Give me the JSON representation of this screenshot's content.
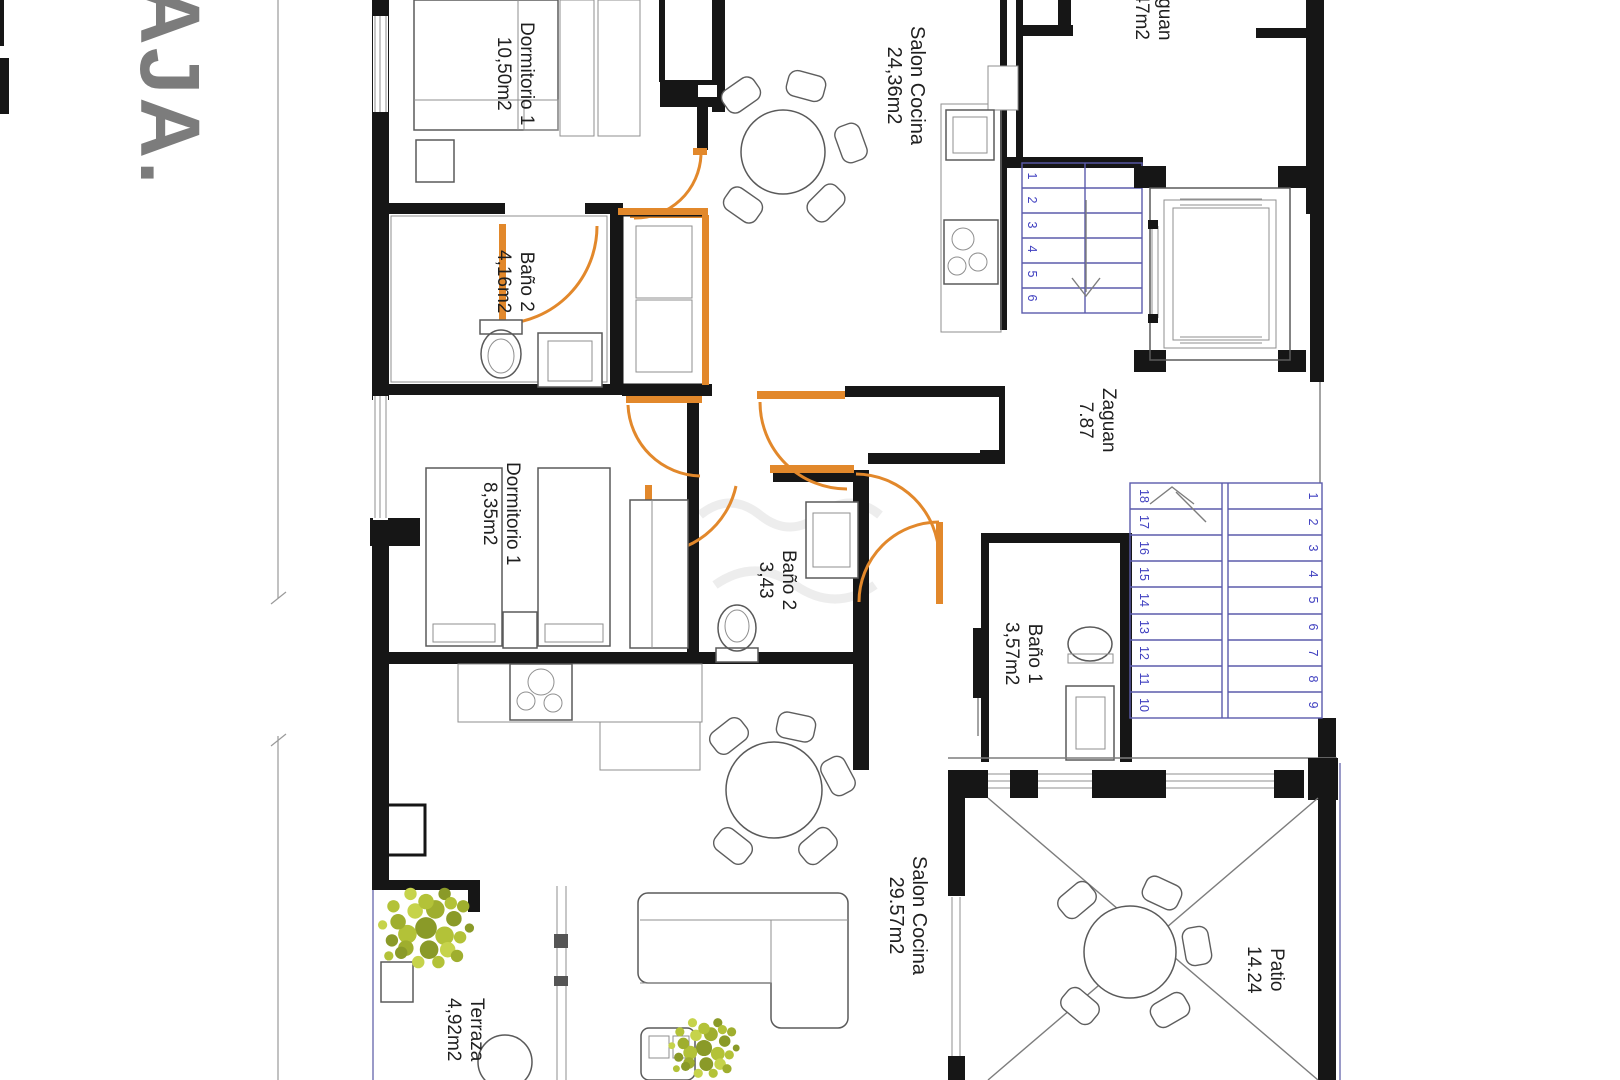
{
  "sheet": {
    "title_visible": "AJA.",
    "title_color": "#7c7c7c"
  },
  "rooms": {
    "dorm1_upper": {
      "name": "Dormitorio 1",
      "area": "10,50m2"
    },
    "salon_upper": {
      "name": "Salon Cocina",
      "area": "24,36m2"
    },
    "bano2_upper": {
      "name": "Baño 2",
      "area": "4,16m2"
    },
    "zaguan_upper": {
      "name": "Zaguan",
      "area": "7,47m2"
    },
    "zaguan_mid": {
      "name": "Zaguan",
      "area": "7.87"
    },
    "dorm1_lower": {
      "name": "Dormitorio 1",
      "area": "8,35m2"
    },
    "bano2_lower": {
      "name": "Baño 2",
      "area": "3,43"
    },
    "bano1_lower": {
      "name": "Baño 1",
      "area": "3,57m2"
    },
    "salon_lower": {
      "name": "Salon Cocina",
      "area": "29.57m2"
    },
    "terraza": {
      "name": "Terraza",
      "area": "4,92m2"
    },
    "patio": {
      "name": "Patio",
      "area": "14.24"
    }
  },
  "stairs": {
    "upper": [
      "1",
      "2",
      "3",
      "4",
      "5",
      "6"
    ],
    "lower_left": [
      "18",
      "17",
      "16",
      "15",
      "14",
      "13",
      "12",
      "11",
      "10"
    ],
    "lower_right": [
      "1",
      "2",
      "3",
      "4",
      "5",
      "6",
      "7",
      "8",
      "9"
    ],
    "number_color": "#4040c0"
  },
  "colors": {
    "wall": "#161616",
    "door_accent": "#e2882b",
    "stair_line": "#5b5bac",
    "stair_number": "#4040c0",
    "plant_green": "#aebe3a",
    "plant_dark": "#8a9a28",
    "title_gray": "#7c7c7c"
  }
}
